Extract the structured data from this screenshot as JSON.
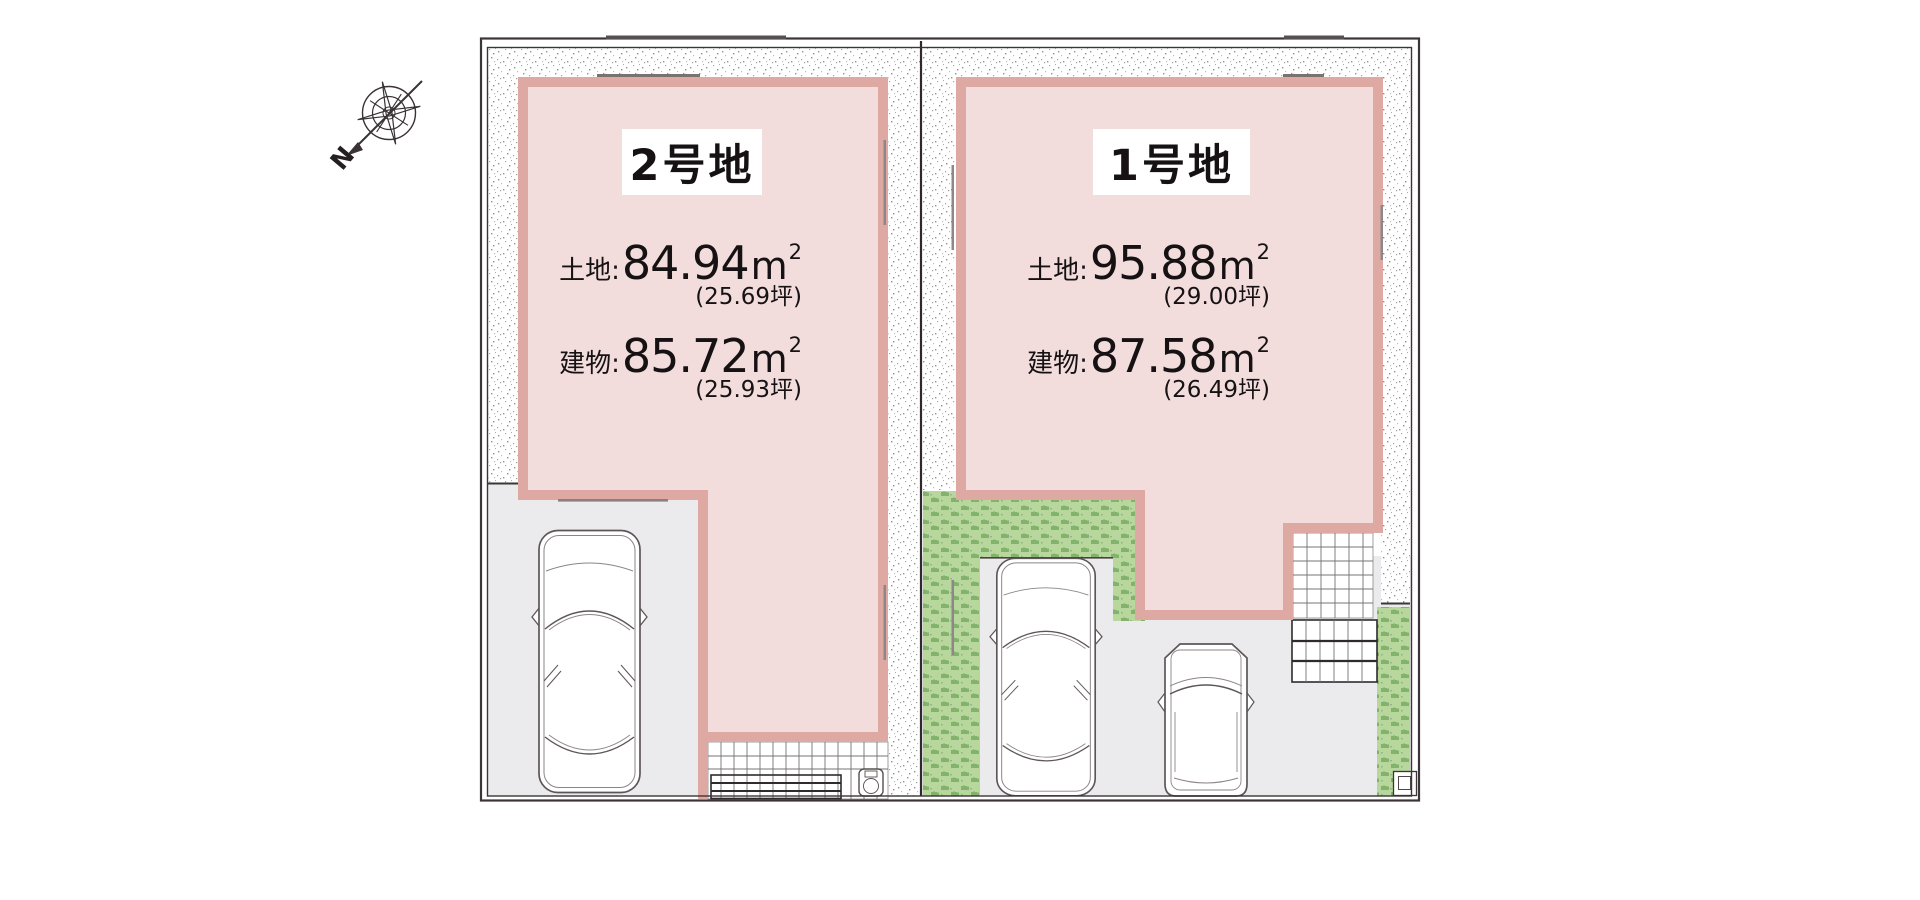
{
  "compass": {
    "north_label": "N"
  },
  "units": {
    "sqm_base": "m",
    "sqm_sup": "2"
  },
  "lots": [
    {
      "name": "2号地",
      "land_label": "土地:",
      "land_value": "84.94",
      "land_tsubo": "(25.69坪)",
      "building_label": "建物:",
      "building_value": "85.72",
      "building_tsubo": "(25.93坪)"
    },
    {
      "name": "1号地",
      "land_label": "土地:",
      "land_value": "95.88",
      "land_tsubo": "(29.00坪)",
      "building_label": "建物:",
      "building_value": "87.58",
      "building_tsubo": "(26.49坪)"
    }
  ],
  "colors": {
    "building_fill": "#f2dddc",
    "building_border": "#dfa9a3",
    "ground": "#ebebed",
    "grass_base": "#b7d79c",
    "grass_tuft": "#4f8e3d",
    "stipple_dot": "#969696",
    "outline": "#3b3537",
    "text": "#161214"
  }
}
